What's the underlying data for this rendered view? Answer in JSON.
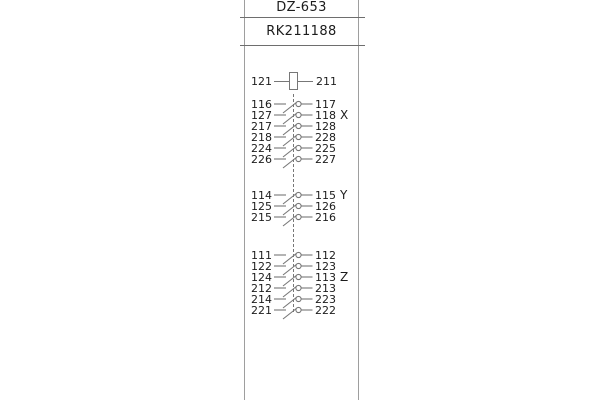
{
  "header": {
    "model": "DZ-653",
    "code": "RK211188"
  },
  "coil": {
    "left_terminal": "121",
    "right_terminal": "211"
  },
  "groups": [
    {
      "name": "X",
      "label_row": 1,
      "rows": [
        [
          "116",
          "117"
        ],
        [
          "127",
          "118"
        ],
        [
          "217",
          "128"
        ],
        [
          "218",
          "228"
        ],
        [
          "224",
          "225"
        ],
        [
          "226",
          "227"
        ]
      ]
    },
    {
      "name": "Y",
      "label_row": 0,
      "rows": [
        [
          "114",
          "115"
        ],
        [
          "125",
          "126"
        ],
        [
          "215",
          "216"
        ]
      ]
    },
    {
      "name": "Z",
      "label_row": 2,
      "rows": [
        [
          "111",
          "112"
        ],
        [
          "122",
          "123"
        ],
        [
          "124",
          "113"
        ],
        [
          "212",
          "213"
        ],
        [
          "214",
          "223"
        ],
        [
          "221",
          "222"
        ]
      ]
    }
  ],
  "icons": {
    "coil-icon": "rectangle-coil",
    "contact-switch-icon": "normally-open-contact",
    "linkage-line": "dashed-vertical-link"
  },
  "colors": {
    "line": "#777777",
    "rail": "#9e9e9e",
    "text": "#1c1c1c"
  }
}
